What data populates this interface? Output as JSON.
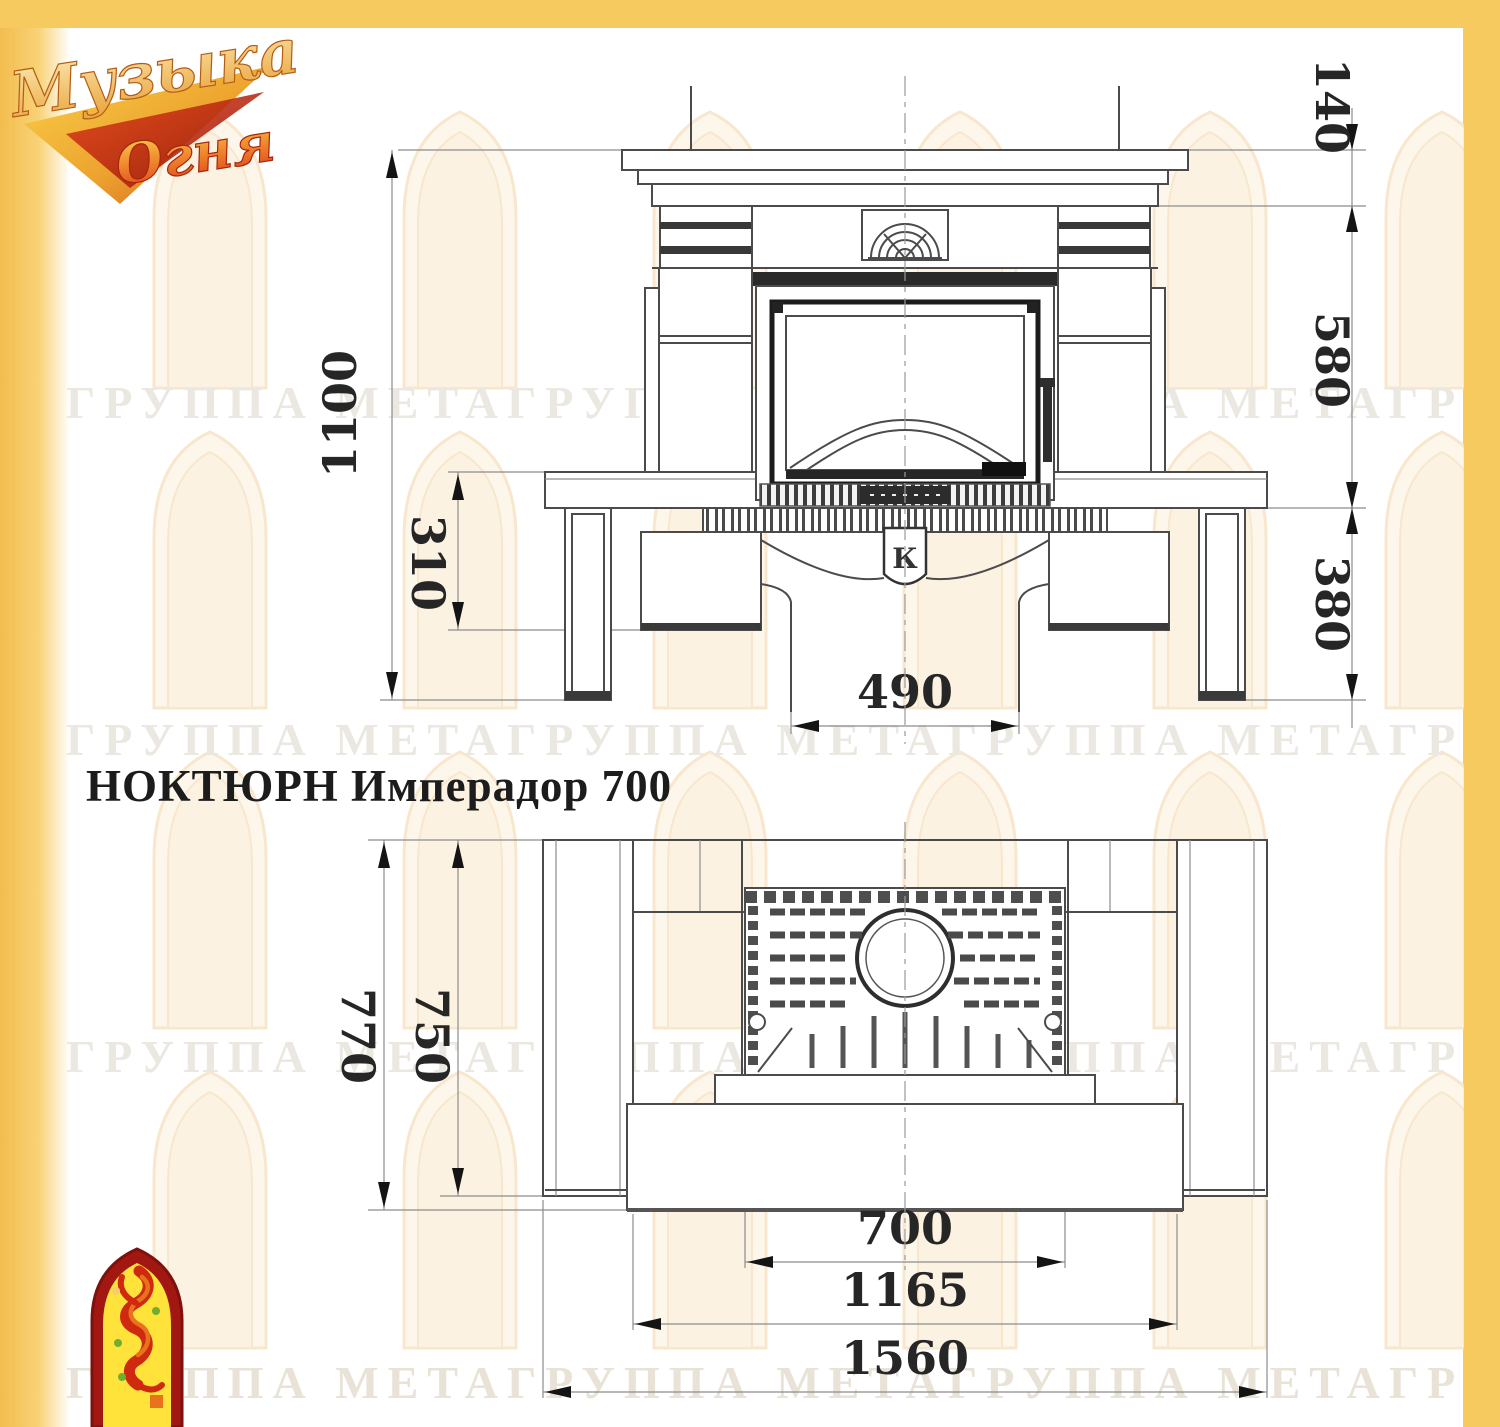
{
  "frame": {
    "color": "#f7ca60"
  },
  "brand": {
    "line1": "Музыка",
    "line2": "Огня"
  },
  "title": "НОКТЮРН Имперадор 700",
  "watermark": {
    "row_text": "ГРУППА МЕТАГРУППА МЕТАГРУППА МЕТАГРУППА МЕТА"
  },
  "front_view": {
    "dim_total_height": "1100",
    "dim_plinth_height": "310",
    "dim_cornice_height": "140",
    "dim_firebox_height": "580",
    "dim_base_height": "380",
    "dim_foot_width": "490",
    "emblem_letter": "К"
  },
  "plan_view": {
    "dim_total_depth": "770",
    "dim_body_depth": "750",
    "dim_insert_width": "700",
    "dim_body_width": "1165",
    "dim_total_width": "1560"
  }
}
